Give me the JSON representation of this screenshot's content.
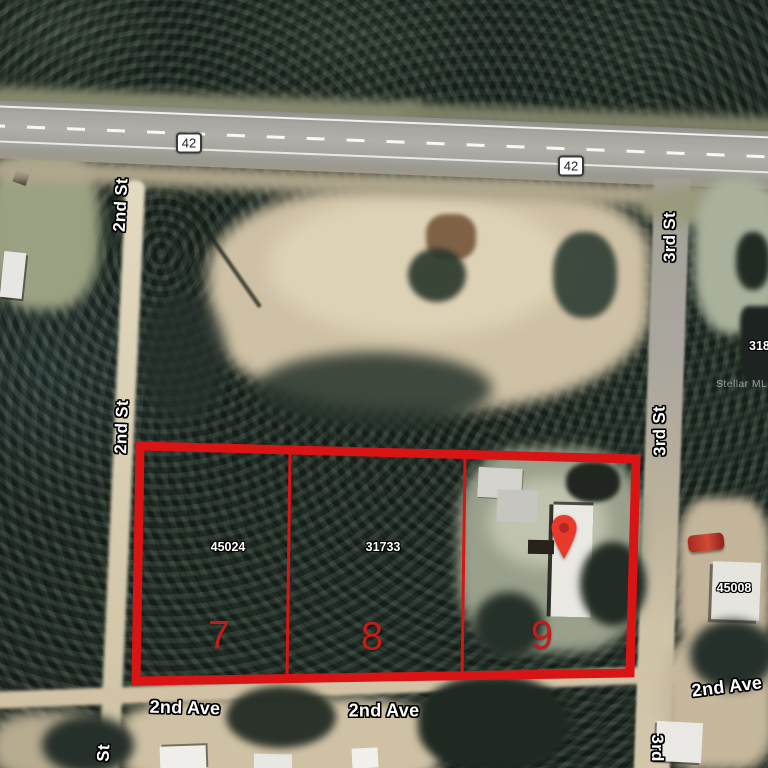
{
  "watermark": "Stellar MLS",
  "highway": {
    "shield_west": "42",
    "shield_east": "42"
  },
  "streets": {
    "second_st_upper": "2nd St",
    "second_st_lower": "2nd St",
    "third_st_upper": "3rd St",
    "third_st_lower": "3rd St",
    "second_ave_left": "2nd Ave",
    "second_ave_center": "2nd Ave",
    "second_ave_right": "2nd Ave",
    "third_st_bottom": "3rd",
    "second_st_bottom_partial": "St"
  },
  "parcels": {
    "lot7": {
      "lot_number": "7",
      "parcel_id": "45024"
    },
    "lot8": {
      "lot_number": "8",
      "parcel_id": "31733"
    },
    "lot9": {
      "lot_number": "9"
    },
    "east_neighbor": {
      "parcel_id": "45008"
    },
    "northeast_neighbor": {
      "parcel_id_partial": "318"
    }
  },
  "colors": {
    "parcel_outline": "#d81414",
    "lot_number_red": "#c21d1a",
    "pin_red": "#e83a2a",
    "pin_hole": "#b0281e"
  }
}
